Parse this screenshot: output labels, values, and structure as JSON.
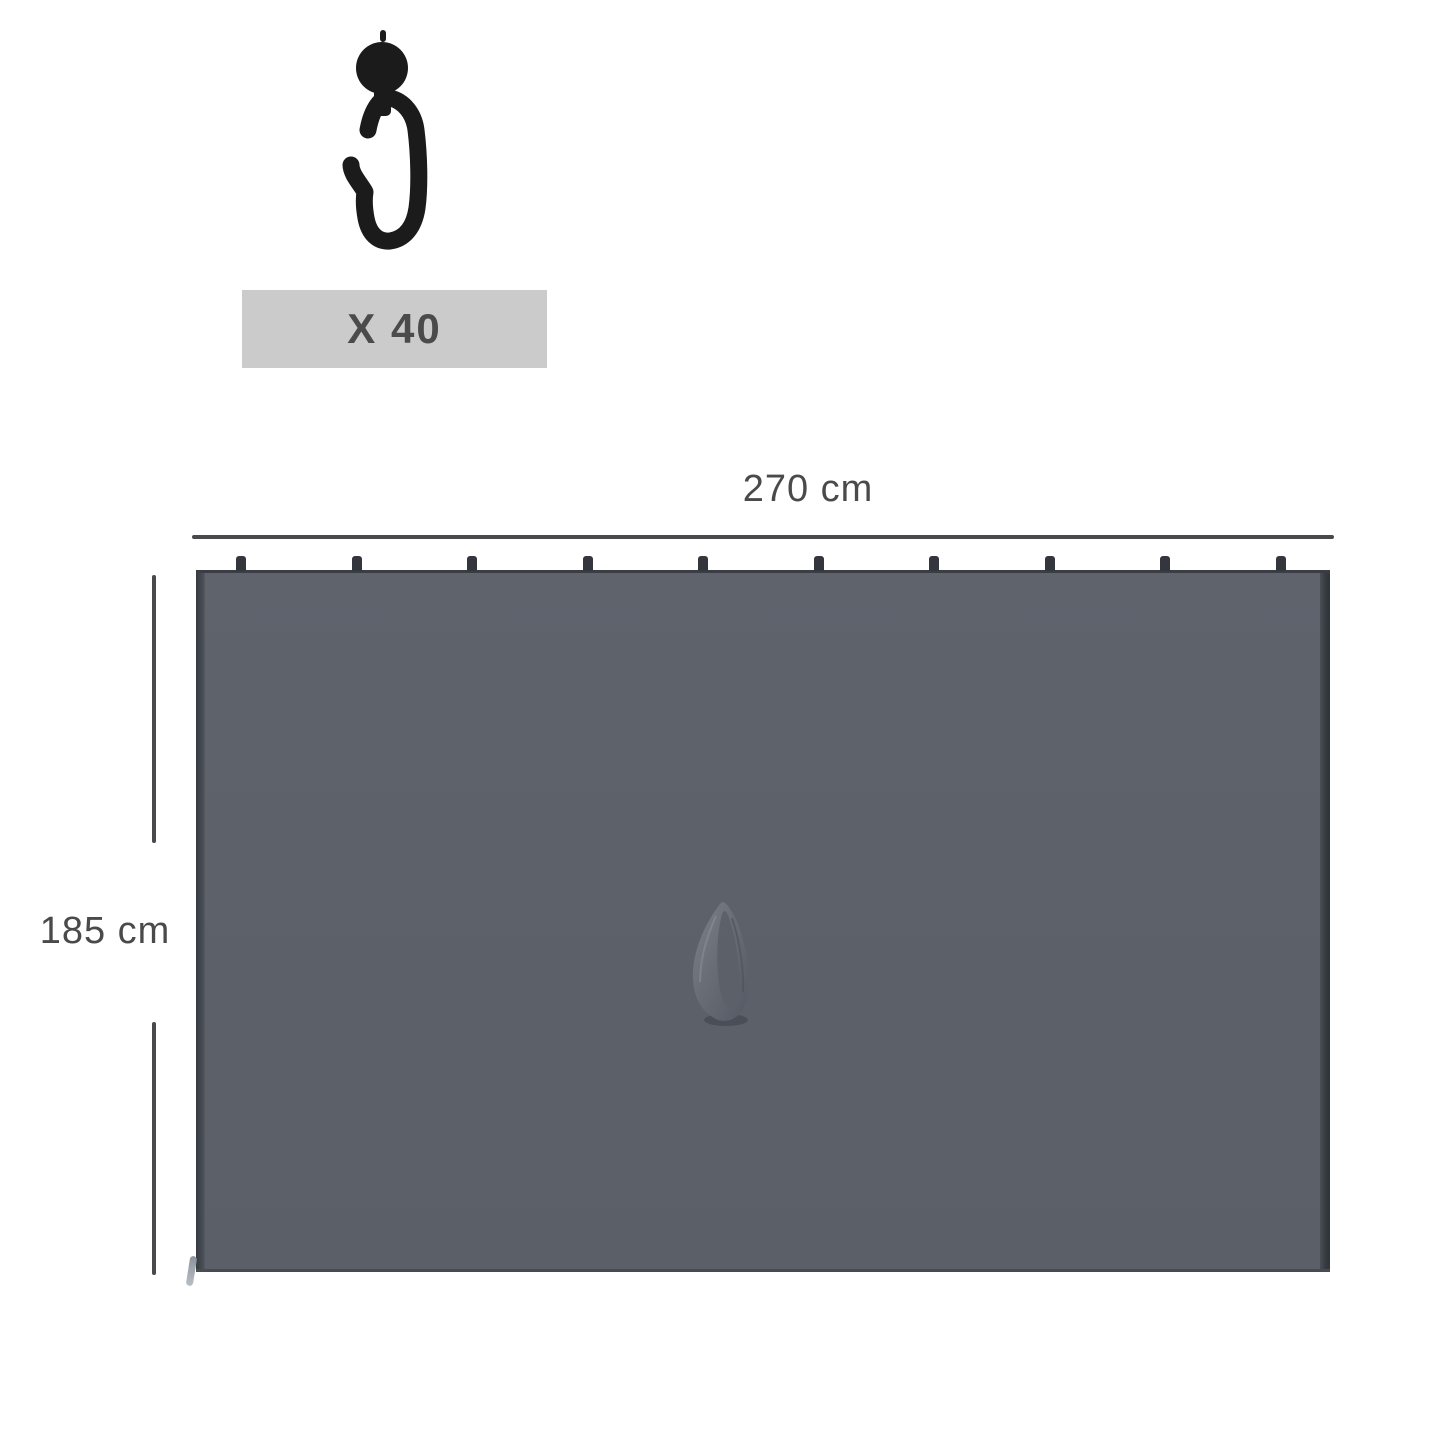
{
  "hook_item": {
    "icon": "curtain-hook-icon",
    "quantity_label": "X 40"
  },
  "dimensions": {
    "width_label": "270 cm",
    "height_label": "185 cm"
  },
  "curtain": {
    "hook_tab_count": 10,
    "handle_icon": "fabric-loop-handle-icon",
    "zipper_icon": "zipper-pull-icon"
  },
  "colors": {
    "bg": "#ffffff",
    "dimension_line": "#47494d",
    "label_text": "#4a4a4a",
    "quantity_box_bg": "#cbcbcb",
    "quantity_text": "#4b4b4b",
    "hook_black": "#1b1b1b",
    "curtain_fill": "#5d6169",
    "curtain_edge_dark": "#363a41",
    "curtain_tab": "#33363c"
  }
}
